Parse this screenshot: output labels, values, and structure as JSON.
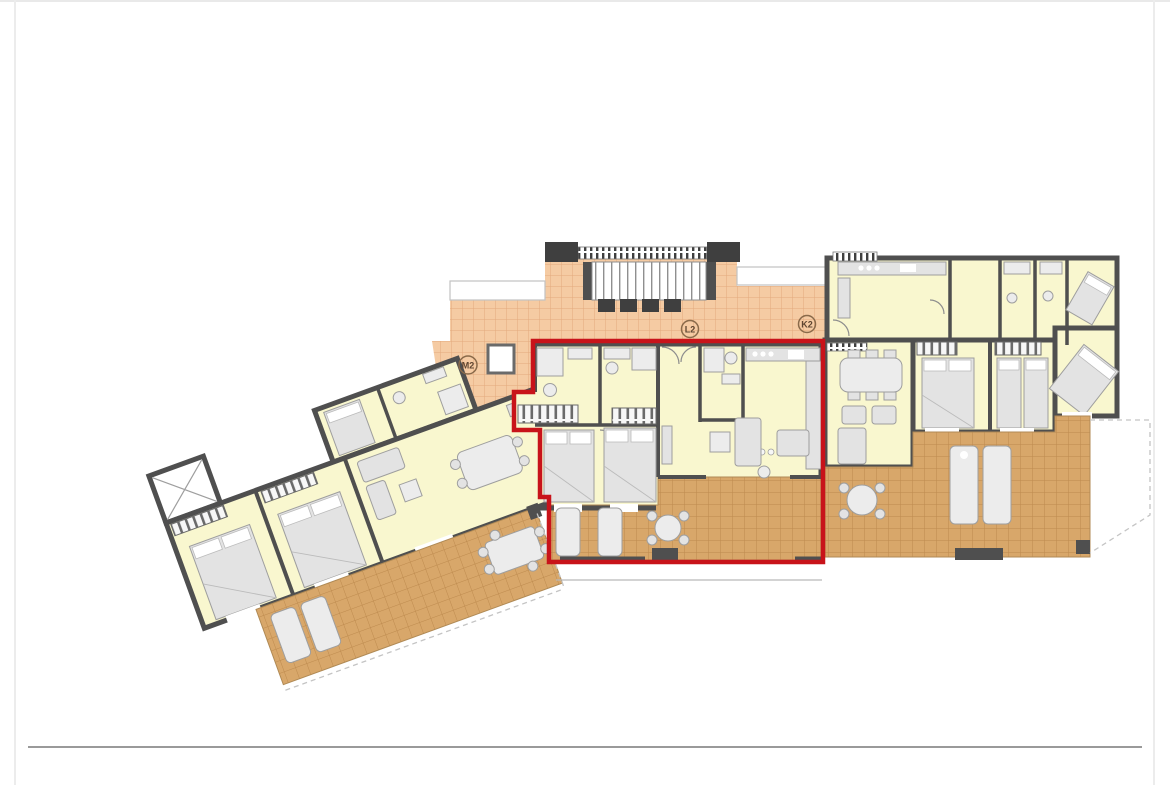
{
  "page": {
    "background": "#ffffff",
    "side_border_color": "#ececec",
    "footer_rule_color": "#9a9a9a",
    "content_type": "architectural floor plan drawing"
  },
  "plan": {
    "colors": {
      "room_fill": "#f9f7cf",
      "wall": "#4f4f4f",
      "corridor_tile": "#f5cba3",
      "terrace_tile": "#d8a76a",
      "highlight": "#c8131a",
      "furniture": "#e3e3e3"
    },
    "units": [
      {
        "id": "left-wing",
        "label": "M2",
        "highlighted": false
      },
      {
        "id": "middle",
        "label": "L2",
        "highlighted": true
      },
      {
        "id": "right-wing",
        "label": "K2",
        "highlighted": false
      }
    ],
    "highlighted_unit": "L2"
  }
}
